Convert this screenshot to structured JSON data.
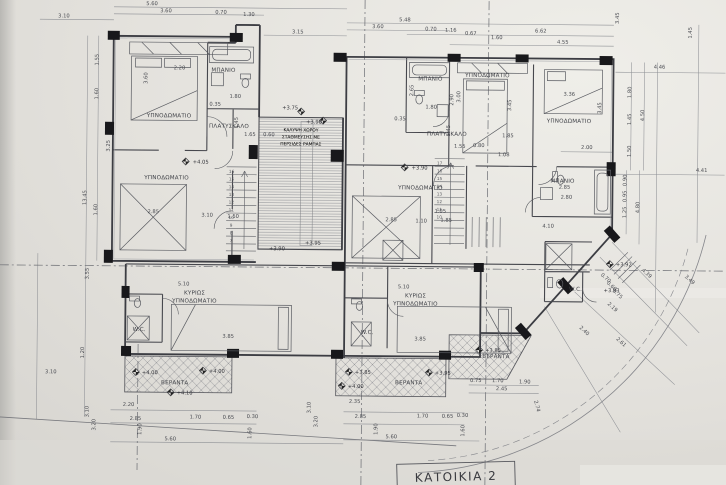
{
  "title": {
    "sheet_label": "ΚΑΤΟΙΚΙΑ 2"
  },
  "rooms": {
    "bedroom": "ΥΠΝΟΔΩΜΑΤΙΟ",
    "master1": "ΚΥΡΙΩΣ",
    "master2": "ΥΠΝΟΔΩΜΑΤΙΟ",
    "bathroom": "ΜΠΑΝΙΟ",
    "landing": "ΠΛΑΤΥΣΚΑΛΟ",
    "veranda": "ΒΕΡΑΝΤΑ",
    "wc": "W.C."
  },
  "void_area": {
    "line1": "ΚΑΛΥΨΗ ΧΩΡΟΥ",
    "line2": "ΣΤΑΘΜΕΥΣΗΣ ΜΕ",
    "line3": "ΠΕΡΣΙΔΕΣ ΡΑΜΠΑΣ"
  },
  "elevations": [
    "+3.75",
    "+3.90",
    "+4.05",
    "+3.90",
    "+3.90",
    "+3.95",
    "+4.00",
    "+4.00",
    "+4.10",
    "+3.85",
    "+3.95",
    "+4.00",
    "+3.85",
    "+3.92",
    "+3.93"
  ],
  "stairs": {
    "left_steps": [
      "16",
      "15",
      "14",
      "13",
      "12",
      "11",
      "10",
      "9",
      "8",
      "7"
    ],
    "right_steps": [
      "17",
      "16",
      "15",
      "14",
      "13",
      "12",
      "11",
      "10"
    ]
  },
  "dims": {
    "top": [
      "3.10",
      "5.60",
      "3.60",
      "0.70",
      "1.30",
      "3.15",
      "5.48",
      "3.60",
      "0.70",
      "1.16",
      "0.67",
      "1.60",
      "6.62",
      "4.55",
      "3.45",
      "1.45"
    ],
    "left": [
      "1.55",
      "1.60",
      "3.25",
      "13.45",
      "1.60",
      "3.55",
      "1.20",
      "3.10"
    ],
    "right": [
      "4.46",
      "1.80",
      "1.45",
      "4.50",
      "1.50",
      "2.00",
      "4.41",
      "0.90",
      "0.95",
      "1.25",
      "4.80"
    ],
    "bottom_left": [
      "2.20",
      "2.85",
      "1.70",
      "0.65",
      "0.30",
      "1.90",
      "1.60",
      "5.60",
      "3.10",
      "3.20"
    ],
    "bottom_mid": [
      "2.35",
      "2.85",
      "1.70",
      "0.65",
      "0.30",
      "1.90",
      "1.60",
      "5.60",
      "3.10",
      "3.20",
      "0.75",
      "1.70",
      "1.90",
      "2.45",
      "2.74"
    ],
    "corner": [
      "4.39",
      "3.49",
      "2.19",
      "0.70",
      "0.60",
      "0.75",
      "2.40",
      "2.61"
    ],
    "interior": [
      "2.20",
      "3.60",
      "1.80",
      "0.35",
      "1.45",
      "1.65",
      "0.60",
      "2.85",
      "3.10",
      "1.50",
      "2.65",
      "1.80",
      "0.35",
      "1.45",
      "1.55",
      "0.80",
      "1.85",
      "1.08",
      "3.00",
      "3.45",
      "2.90",
      "3.36",
      "3.45",
      "2.85",
      "1.10",
      "2.85",
      "2.80",
      "4.10",
      "5.10",
      "5.10",
      "3.85",
      "3.85",
      "1.05",
      "1.85"
    ]
  },
  "colors": {
    "paper": "#e4e2dd",
    "ink": "#3c3d43",
    "faint": "#8e9095",
    "column": "#18181b"
  }
}
